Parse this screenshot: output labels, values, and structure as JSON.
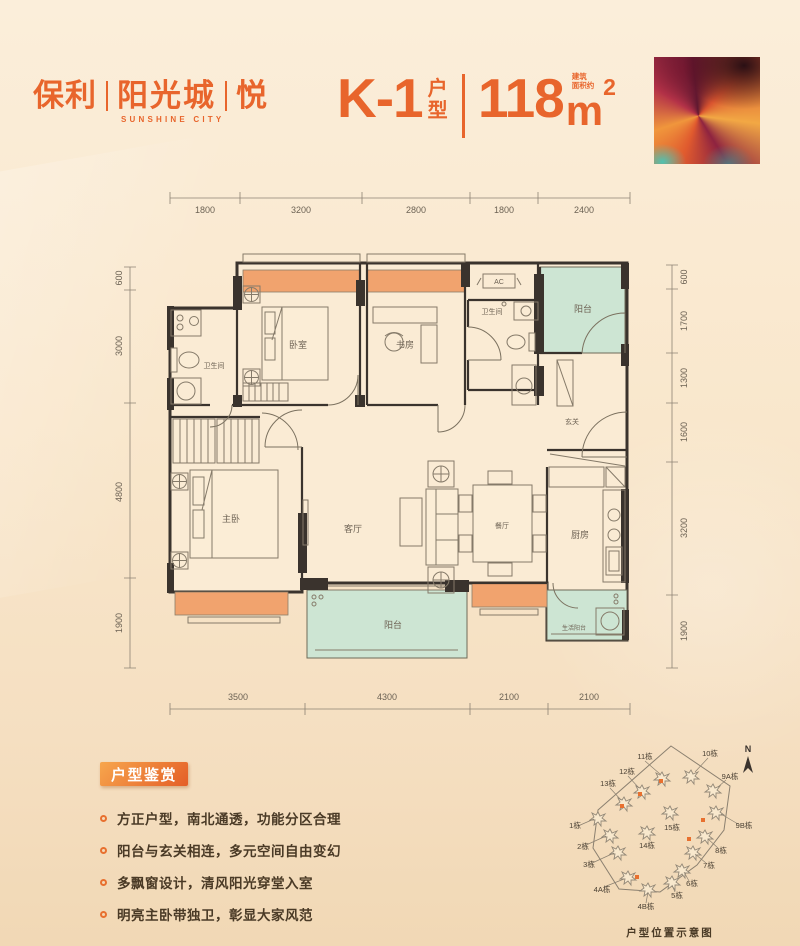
{
  "logo": {
    "part1": "保利",
    "part2": "阳光城",
    "part3": "悦",
    "en": "SUNSHINE CITY"
  },
  "title": {
    "code": "K-1",
    "type_label": "户型",
    "area_value": "118",
    "area_unit": "m",
    "area_sup": "2",
    "area_note_line1": "建筑",
    "area_note_line2": "面积约"
  },
  "plan": {
    "rooms": {
      "bath1": "卫生间",
      "bedroom": "卧室",
      "study": "书房",
      "ac": "AC",
      "bath2": "卫生间",
      "balcony_n": "阳台",
      "foyer": "玄关",
      "master": "主卧",
      "living": "客厅",
      "dining": "餐厅",
      "kitchen": "厨房",
      "balcony_s": "阳台",
      "service_balcony": "生活阳台"
    },
    "dims": {
      "top": [
        "1800",
        "3200",
        "2800",
        "1800",
        "2400"
      ],
      "left": [
        "600",
        "3000",
        "4800",
        "1900"
      ],
      "right": [
        "600",
        "1700",
        "1300",
        "1600",
        "3200",
        "1900"
      ],
      "bottom": [
        "3500",
        "4300",
        "2100",
        "2100"
      ]
    }
  },
  "features": {
    "heading": "户型鉴赏",
    "items": [
      "方正户型，南北通透，功能分区合理",
      "阳台与玄关相连，多元空间自由变幻",
      "多飘窗设计，清风阳光穿堂入室",
      "明亮主卧带独卫，彰显大家风范"
    ]
  },
  "siteplan": {
    "north": "N",
    "caption": "户型位置示意图",
    "buildings": [
      "1栋",
      "2栋",
      "3栋",
      "4A栋",
      "4B栋",
      "5栋",
      "6栋",
      "7栋",
      "8栋",
      "9A栋",
      "9B栋",
      "10栋",
      "11栋",
      "12栋",
      "13栋",
      "14栋",
      "15栋"
    ]
  },
  "colors": {
    "accent": "#E8652C",
    "wall": "#3A332D",
    "bay": "#F1A36E",
    "green": "#CDE5D3"
  }
}
